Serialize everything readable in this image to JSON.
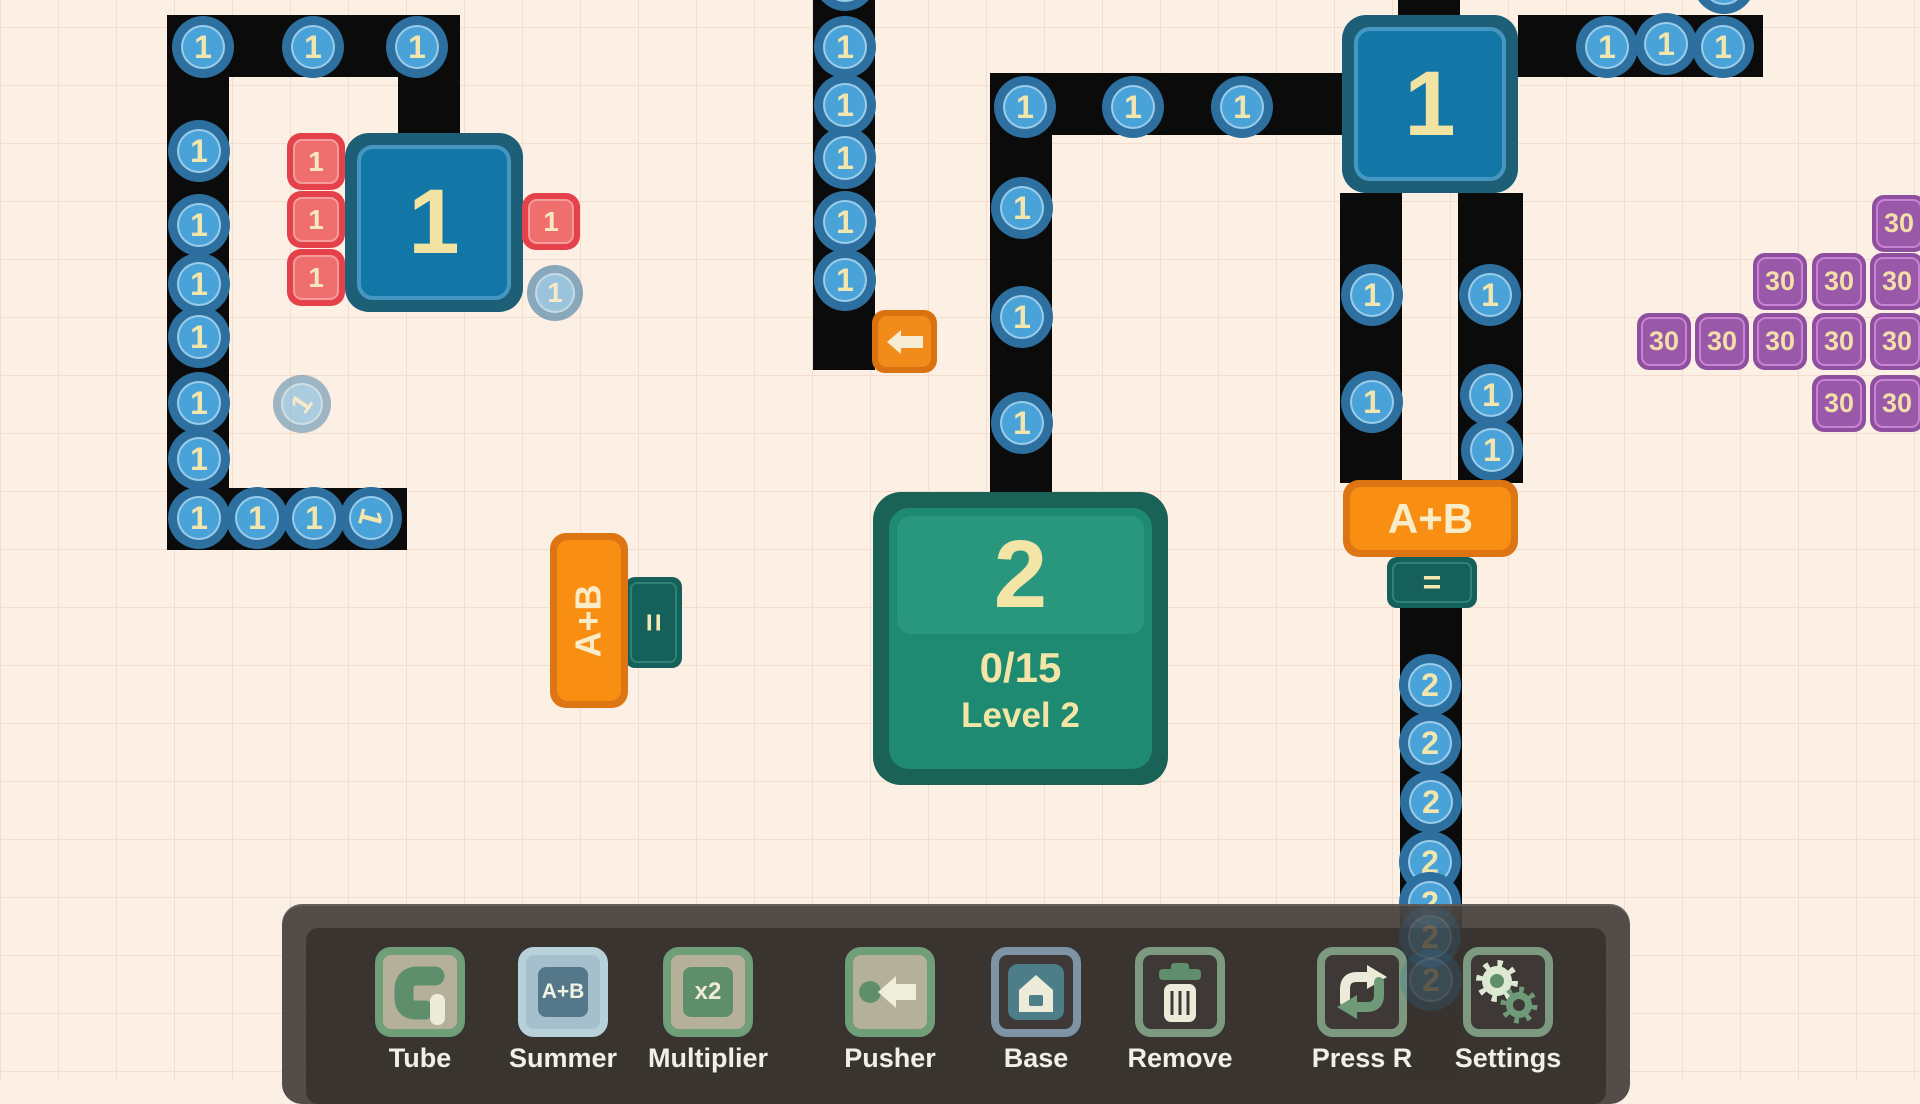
{
  "colors": {
    "background": "#fcefe3",
    "grid_line": "#f3ddcf",
    "tube_black": "#0b0b0b",
    "token_blue_outer": "#2d6f9e",
    "token_blue_inner": "#49a2d8",
    "number_cream": "#f3e5ae",
    "box_teal_outer": "#1d5f76",
    "box_blue_inner": "#1277a7",
    "red_chip": "#e4414b",
    "purple_chip": "#8e509e",
    "base_green_outer": "#1a6156",
    "base_green_inner": "#1f8a72",
    "summer_orange": "#f88e12",
    "eq_teal": "#15605a",
    "pusher_orange": "#f18c1a",
    "toolbar_gray": "#48423d",
    "toolbar_icon_sage": "#6f9e79",
    "toolbar_icon_blue": "#7e93a3"
  },
  "field": {
    "paths": [
      {
        "x": 167,
        "y": 15,
        "w": 293,
        "h": 62
      },
      {
        "x": 398,
        "y": 62,
        "w": 62,
        "h": 75
      },
      {
        "x": 167,
        "y": 15,
        "w": 62,
        "h": 535
      },
      {
        "x": 167,
        "y": 488,
        "w": 240,
        "h": 62
      },
      {
        "x": 813,
        "y": 0,
        "w": 62,
        "h": 370
      },
      {
        "x": 990,
        "y": 73,
        "w": 352,
        "h": 62
      },
      {
        "x": 990,
        "y": 73,
        "w": 62,
        "h": 419
      },
      {
        "x": 1398,
        "y": 0,
        "w": 62,
        "h": 18
      },
      {
        "x": 1518,
        "y": 15,
        "w": 245,
        "h": 62
      },
      {
        "x": 1340,
        "y": 193,
        "w": 62,
        "h": 290
      },
      {
        "x": 1458,
        "y": 193,
        "w": 65,
        "h": 290
      },
      {
        "x": 1400,
        "y": 608,
        "w": 62,
        "h": 472
      }
    ],
    "tokens": [
      {
        "v": "1",
        "x": 203,
        "y": 47
      },
      {
        "v": "1",
        "x": 313,
        "y": 47
      },
      {
        "v": "1",
        "x": 417,
        "y": 47
      },
      {
        "v": "1",
        "x": 199,
        "y": 151
      },
      {
        "v": "1",
        "x": 199,
        "y": 225
      },
      {
        "v": "1",
        "x": 199,
        "y": 284
      },
      {
        "v": "1",
        "x": 199,
        "y": 337
      },
      {
        "v": "1",
        "x": 199,
        "y": 403
      },
      {
        "v": "1",
        "x": 199,
        "y": 459
      },
      {
        "v": "1",
        "x": 199,
        "y": 518
      },
      {
        "v": "1",
        "x": 257,
        "y": 518
      },
      {
        "v": "1",
        "x": 314,
        "y": 518
      },
      {
        "v": "1",
        "x": 371,
        "y": 518,
        "rot": 105
      },
      {
        "v": "1",
        "x": 302,
        "y": 404,
        "r": 29,
        "o": 0.45,
        "rot": -55
      },
      {
        "v": "1",
        "x": 555,
        "y": 293,
        "r": 28,
        "o": 0.55
      },
      {
        "v": "1",
        "x": 845,
        "y": -20
      },
      {
        "v": "1",
        "x": 845,
        "y": 47
      },
      {
        "v": "1",
        "x": 845,
        "y": 105
      },
      {
        "v": "1",
        "x": 845,
        "y": 158
      },
      {
        "v": "1",
        "x": 845,
        "y": 222
      },
      {
        "v": "1",
        "x": 845,
        "y": 280
      },
      {
        "v": "1",
        "x": 1025,
        "y": 107
      },
      {
        "v": "1",
        "x": 1133,
        "y": 107
      },
      {
        "v": "1",
        "x": 1242,
        "y": 107
      },
      {
        "v": "1",
        "x": 1022,
        "y": 208
      },
      {
        "v": "1",
        "x": 1022,
        "y": 317
      },
      {
        "v": "1",
        "x": 1022,
        "y": 423
      },
      {
        "v": "1",
        "x": 1607,
        "y": 47
      },
      {
        "v": "1",
        "x": 1666,
        "y": 44
      },
      {
        "v": "1",
        "x": 1723,
        "y": 47
      },
      {
        "v": "1",
        "x": 1724,
        "y": -17
      },
      {
        "v": "1",
        "x": 1372,
        "y": 295
      },
      {
        "v": "1",
        "x": 1372,
        "y": 402
      },
      {
        "v": "1",
        "x": 1490,
        "y": 295
      },
      {
        "v": "1",
        "x": 1491,
        "y": 395
      },
      {
        "v": "1",
        "x": 1492,
        "y": 450
      },
      {
        "v": "2",
        "x": 1430,
        "y": 685
      },
      {
        "v": "2",
        "x": 1430,
        "y": 743
      },
      {
        "v": "2",
        "x": 1431,
        "y": 802
      },
      {
        "v": "2",
        "x": 1430,
        "y": 862
      },
      {
        "v": "2",
        "x": 1430,
        "y": 903
      },
      {
        "v": "2",
        "x": 1430,
        "y": 937,
        "o": 0.22,
        "ghost": true
      },
      {
        "v": "2",
        "x": 1431,
        "y": 980,
        "o": 0.22,
        "ghost": true
      }
    ],
    "boxes": [
      {
        "label": "1",
        "x": 345,
        "y": 133,
        "w": 178,
        "h": 179
      },
      {
        "label": "1",
        "x": 1342,
        "y": 15,
        "w": 176,
        "h": 178
      }
    ],
    "red_chips": [
      {
        "label": "1",
        "x": 287,
        "y": 133
      },
      {
        "label": "1",
        "x": 287,
        "y": 191
      },
      {
        "label": "1",
        "x": 287,
        "y": 249
      },
      {
        "label": "1",
        "x": 522,
        "y": 193
      }
    ],
    "purple_chips": [
      {
        "label": "30",
        "x": 1872,
        "y": 195
      },
      {
        "label": "30",
        "x": 1753,
        "y": 253
      },
      {
        "label": "30",
        "x": 1812,
        "y": 253
      },
      {
        "label": "30",
        "x": 1870,
        "y": 253
      },
      {
        "label": "30",
        "x": 1637,
        "y": 313
      },
      {
        "label": "30",
        "x": 1695,
        "y": 313
      },
      {
        "label": "30",
        "x": 1753,
        "y": 313
      },
      {
        "label": "30",
        "x": 1812,
        "y": 313
      },
      {
        "label": "30",
        "x": 1870,
        "y": 313
      },
      {
        "label": "30",
        "x": 1812,
        "y": 375
      },
      {
        "label": "30",
        "x": 1870,
        "y": 375
      }
    ],
    "base": {
      "x": 873,
      "y": 492,
      "w": 295,
      "h": 293,
      "number": "2",
      "progress": "0/15",
      "level": "Level 2"
    },
    "summers": [
      {
        "label": "A+B",
        "eq": "=",
        "orient": "h",
        "x": 1343,
        "y": 480,
        "w": 175,
        "h": 77,
        "eqx": 1387,
        "eqy": 557,
        "eqw": 90,
        "eqh": 51
      },
      {
        "label": "A+B",
        "eq": "=",
        "orient": "v",
        "x": 550,
        "y": 533,
        "w": 78,
        "h": 175,
        "eqx": 625,
        "eqy": 577,
        "eqw": 57,
        "eqh": 91
      }
    ],
    "pushers": [
      {
        "x": 872,
        "y": 310,
        "w": 65,
        "h": 63,
        "dir": "left"
      }
    ]
  },
  "toolbar": {
    "tools": [
      {
        "id": "tube",
        "label": "Tube"
      },
      {
        "id": "summer",
        "label": "Summer"
      },
      {
        "id": "multiplier",
        "label": "Multiplier"
      },
      {
        "id": "pusher",
        "label": "Pusher"
      },
      {
        "id": "base",
        "label": "Base"
      },
      {
        "id": "remove",
        "label": "Remove"
      },
      {
        "id": "press-r",
        "label": "Press R"
      },
      {
        "id": "settings",
        "label": "Settings"
      }
    ],
    "centers": [
      420,
      563,
      708,
      890,
      1036,
      1180,
      1362,
      1508
    ]
  }
}
